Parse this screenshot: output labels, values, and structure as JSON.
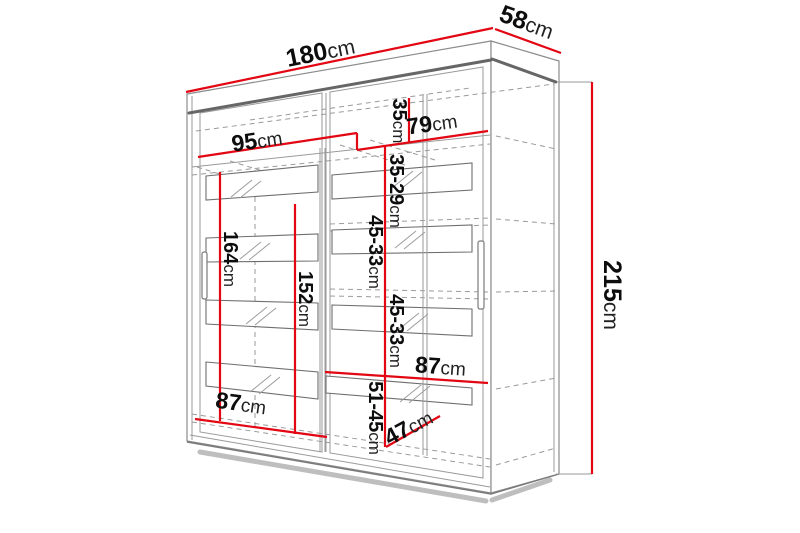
{
  "diagram": {
    "type": "wardrobe-dimension-drawing",
    "unit": "cm",
    "colors": {
      "dimension_line": "#e30613",
      "structure": "#8b8b8b",
      "label_text": "#0d0d0d",
      "background": "#ffffff"
    },
    "dims": {
      "total_width": {
        "num": "180",
        "unit": "cm"
      },
      "total_depth": {
        "num": "58",
        "unit": "cm"
      },
      "total_height": {
        "num": "215",
        "unit": "cm"
      },
      "left_section_width": {
        "num": "95",
        "unit": "cm"
      },
      "right_section_width": {
        "num": "79",
        "unit": "cm"
      },
      "top_gap": {
        "num": "35",
        "unit": "cm"
      },
      "gap_35_29": {
        "num": "35-29",
        "unit": "cm"
      },
      "gap_45_33_a": {
        "num": "45-33",
        "unit": "cm"
      },
      "gap_45_33_b": {
        "num": "45-33",
        "unit": "cm"
      },
      "gap_51_45": {
        "num": "51-45",
        "unit": "cm"
      },
      "left_inner_height": {
        "num": "164",
        "unit": "cm"
      },
      "middle_inner_height": {
        "num": "152",
        "unit": "cm"
      },
      "left_door_width": {
        "num": "87",
        "unit": "cm"
      },
      "right_shelf_width": {
        "num": "87",
        "unit": "cm"
      },
      "inner_depth": {
        "num": "47",
        "unit": "cm"
      }
    }
  }
}
